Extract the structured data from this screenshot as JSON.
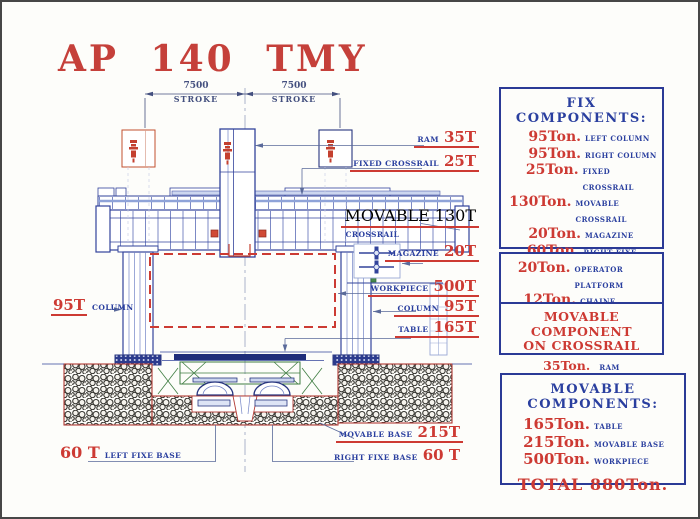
{
  "title": "AP 140 TMY",
  "dimensions": [
    {
      "value": "7500",
      "label": "STROKE"
    },
    {
      "value": "7500",
      "label": "STROKE"
    }
  ],
  "callouts": {
    "ram": {
      "label": "RAM",
      "value": "35T"
    },
    "fixed_crossrail": {
      "label": "FIXED CROSSRAIL",
      "value": "25T"
    },
    "movable_crossrail": {
      "label": "MOVABLE",
      "label2": "CROSSRAIL",
      "value": "130T"
    },
    "magazine": {
      "label": "MAGAZINE",
      "value": "20T"
    },
    "workpiece": {
      "label": "WORKPIECE",
      "value": "500T"
    },
    "right_column": {
      "label": "COLUMN",
      "value": "95T"
    },
    "table": {
      "label": "TABLE",
      "value": "165T"
    },
    "left_column": {
      "value": "95T",
      "label": "COLUMN"
    },
    "movable_base": {
      "label": "MOVABLE BASE",
      "value": "215T"
    },
    "right_fixe_base": {
      "label": "RIGHT FIXE BASE",
      "value": "60 T"
    },
    "left_fixe_base": {
      "value": "60 T",
      "label": "LEFT FIXE BASE"
    }
  },
  "panels": {
    "fix": {
      "title": "FIX COMPONENTS:",
      "items": [
        {
          "value": "95Ton.",
          "label": "LEFT COLUMN"
        },
        {
          "value": "95Ton.",
          "label": "RIGHT COLUMN"
        },
        {
          "value": "25Ton.",
          "label": "FIXED CROSSRAIL"
        },
        {
          "value": "130Ton.",
          "label": "MOVABLE CROSSRAIL"
        },
        {
          "value": "20Ton.",
          "label": "MAGAZINE"
        },
        {
          "value": "60Ton.",
          "label": "RIGHT FIXE BASE"
        },
        {
          "value": "60Ton.",
          "label": "LEFT FIXE BASE"
        }
      ],
      "total": "TOTAL 485Ton."
    },
    "extra": {
      "items": [
        {
          "value": "20Ton.",
          "label": "OPERATOR PLATFORM"
        },
        {
          "value": "12Ton.",
          "label": "CHAINE MAGAZINE"
        }
      ]
    },
    "on_crossrail": {
      "line1": "MOVABLE COMPONENT",
      "line2": "ON CROSSRAIL",
      "value": "35Ton.",
      "label": "RAM"
    },
    "movable": {
      "title": "MOVABLE COMPONENTS:",
      "items": [
        {
          "value": "165Ton.",
          "label": "TABLE"
        },
        {
          "value": "215Ton.",
          "label": "MOVABLE BASE"
        },
        {
          "value": "500Ton.",
          "label": "WORKPIECE"
        }
      ],
      "total": "TOTAL 880Ton."
    }
  },
  "colors": {
    "accent_red": "#cd3a33",
    "accent_blue": "#2a3f9f",
    "drawing_blue": "#32439b",
    "panel_border": "#2b3a96",
    "ghost_orange": "#c2502f",
    "foundation_red": "#b23b35",
    "green": "#3f7d42"
  }
}
